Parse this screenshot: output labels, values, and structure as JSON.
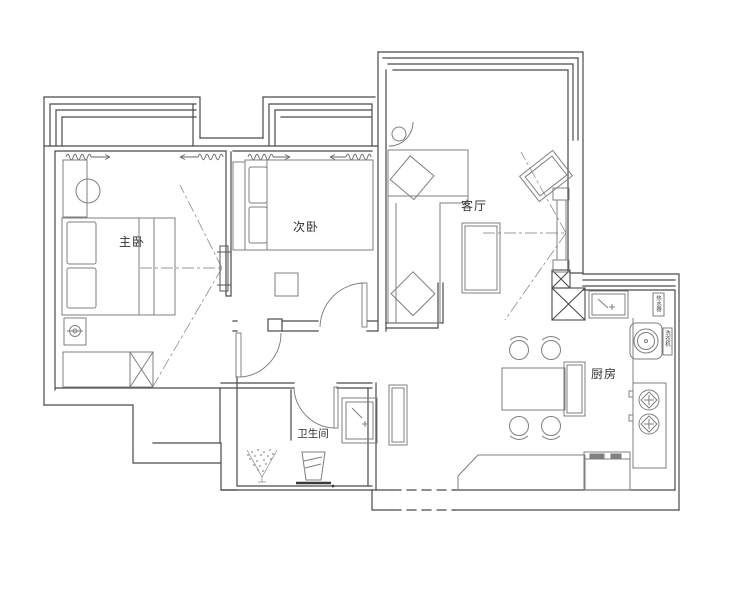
{
  "meta": {
    "title": "apartment floor plan",
    "type": "floor-plan-drawing"
  },
  "colors": {
    "background": "#ffffff",
    "wall": "#4a4a4a",
    "furniture": "#7f7f7f",
    "light_line": "#9a9a9a",
    "text": "#2f2f2f"
  },
  "rooms": [
    {
      "id": "master-bedroom",
      "label": "主卧"
    },
    {
      "id": "second-bedroom",
      "label": "次卧"
    },
    {
      "id": "living-room",
      "label": "客厅"
    },
    {
      "id": "kitchen",
      "label": "厨房"
    },
    {
      "id": "bathroom",
      "label": "卫生间"
    }
  ],
  "appliance_labels": [
    {
      "id": "water-heater",
      "label": "热水器"
    },
    {
      "id": "washing-machine",
      "label": "洗衣机"
    }
  ]
}
